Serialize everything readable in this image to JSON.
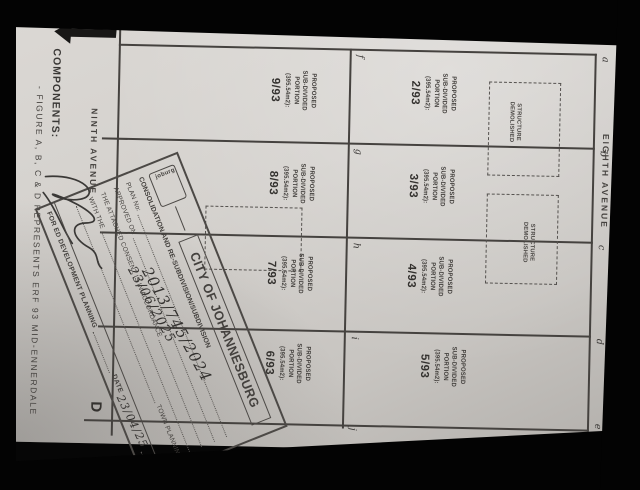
{
  "plan": {
    "components_heading": "COMPONENTS:",
    "components_body": "- FIGURE A, B, C & D REPRESENTS ERF 93 MID-ENNERDALE",
    "street_left": "NINTH AVENUE",
    "street_right": "EIGHTH AVENUE",
    "figure_label": "D",
    "portion_lines": [
      "PROPOSED",
      "SUB-DIVIDED",
      "PORTION",
      "(395.54m2):"
    ],
    "cell_numbers_right": [
      "2/93",
      "3/93",
      "4/93",
      "5/93"
    ],
    "cell_numbers_left": [
      "9/93",
      "8/93",
      "7/93",
      "6/93"
    ],
    "edge_letters_right": [
      "a",
      "b",
      "c",
      "d",
      "e"
    ],
    "edge_letters_mid": [
      "f",
      "g",
      "h",
      "i",
      "j"
    ],
    "structure_note": [
      "STRUCTURE",
      "DEMOLISHED"
    ]
  },
  "stamp": {
    "logo_text": "joburg",
    "title": "CITY OF JOHANNESBURG",
    "subtitle": "CONSOLIDATION AND RE-SUBDIVISION/SUBDIVISION",
    "plan_label": "PLAN No:",
    "plan_value": "2013/745/2024",
    "approved_label": "APPROVED ON",
    "approved_value": "23/06/2025",
    "consent_line": "THE ATTACHED CONSENT IS IN ACCORDANCE",
    "with_label": "WITH THE",
    "town_planning_label": "TOWN PLANNING",
    "date_label": "DATE",
    "date_value": "23/04/25",
    "footer": "FOR ED DEVELOPMENT PLANNING"
  },
  "colors": {
    "paper": "#d6d3cf",
    "ink": "#3a3836",
    "background": "#030303"
  }
}
